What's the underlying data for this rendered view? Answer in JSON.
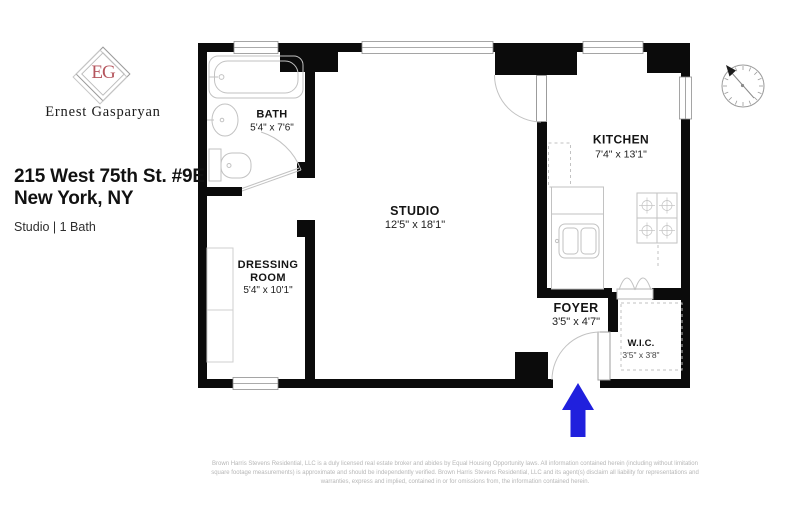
{
  "branding": {
    "monogram": "EG",
    "agent_name": "Ernest Gasparyan"
  },
  "listing": {
    "address_line1": "215 West 75th St. #9E",
    "address_line2": "New York, NY",
    "summary": "Studio | 1 Bath"
  },
  "rooms": {
    "bath": {
      "name": "BATH",
      "dims": "5'4\" x 7'6\""
    },
    "dressing_room": {
      "name_line1": "DRESSING",
      "name_line2": "ROOM",
      "dims": "5'4\" x 10'1\""
    },
    "studio": {
      "name": "STUDIO",
      "dims": "12'5\" x 18'1\""
    },
    "kitchen": {
      "name": "KITCHEN",
      "dims": "7'4\" x 13'1\""
    },
    "foyer": {
      "name": "FOYER",
      "dims": "3'5\" x 4'7\""
    },
    "wic": {
      "name": "W.I.C.",
      "dims": "3'5\" x 3'8\""
    }
  },
  "icons": {
    "compass": "compass-icon",
    "entrance_arrow": "entrance-arrow-icon"
  },
  "colors": {
    "wall": "#0b0b0b",
    "fixture": "#c2c2c2",
    "accent_blue": "#2020dd",
    "monogram": "#b5565e",
    "disclaimer": "#b7b7b7"
  },
  "disclaimer": {
    "line1": "Brown Harris Stevens Residential, LLC is a duly licensed real estate broker and abides by Equal Housing Opportunity laws. All information contained herein (including without limitation",
    "line2": "square footage measurements) is approximate and should be independently verified. Brown Harris Stevens Residential, LLC and its agent(s) disclaim all liability for representations and",
    "line3": "warranties, express and implied, contained in or for omissions from, the information contained herein."
  }
}
